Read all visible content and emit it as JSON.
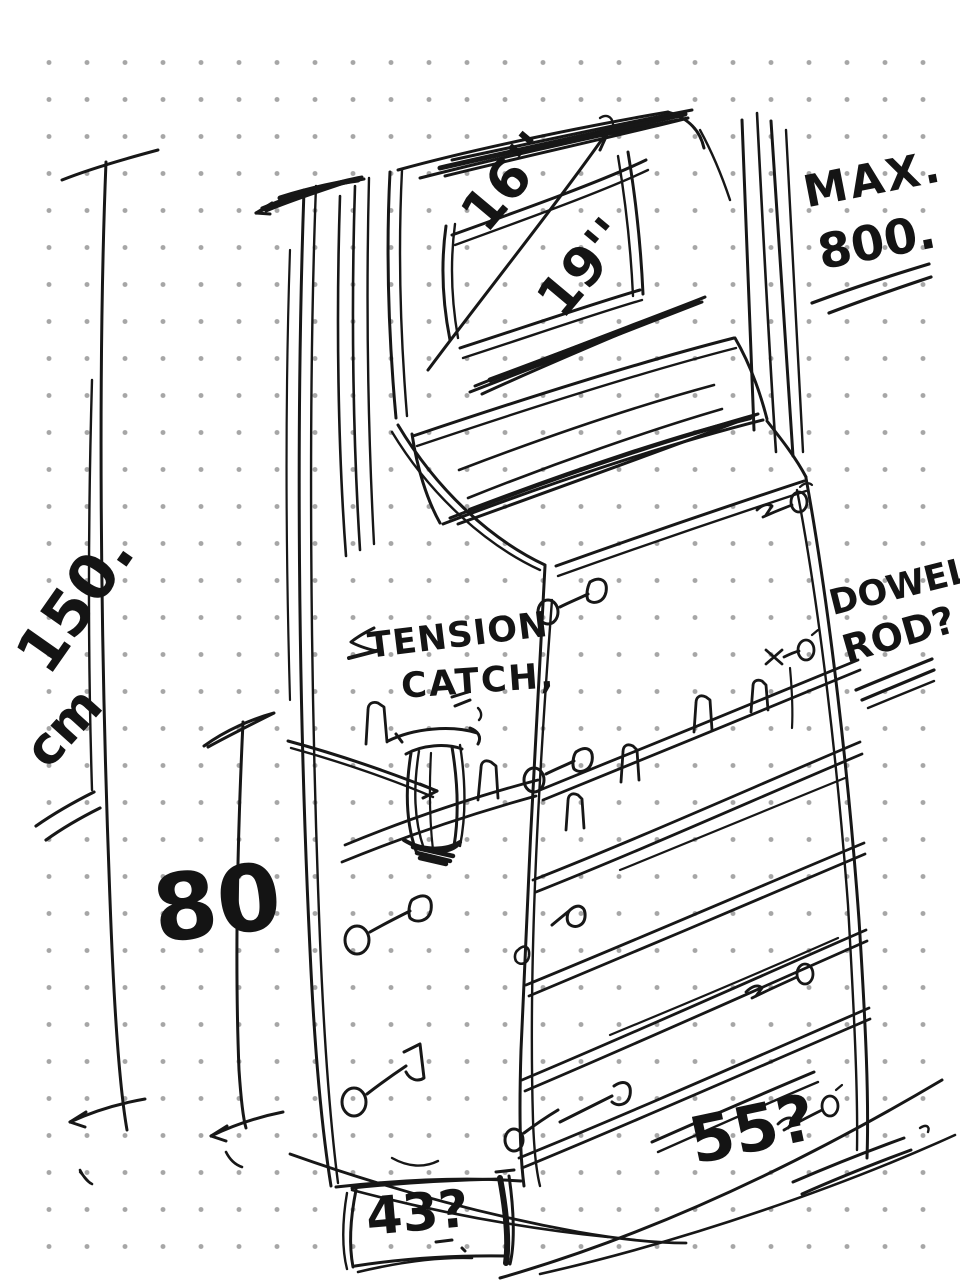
{
  "canvas": {
    "background_color": "#ffffff",
    "dot_color": "#a6a6a6",
    "ink_color": "#171717",
    "description": "Hand-drawn sketch of an arcade-style kiosk cabinet on dotted grid paper"
  },
  "labels": {
    "screen_size_primary": "16''",
    "screen_size_secondary": "19''",
    "max_title": "MAX.",
    "max_value": "800.",
    "total_height_value": "150.",
    "total_height_unit": "cm",
    "body_height_value": "80",
    "catch_note_line1": "TENSION",
    "catch_note_line2": "CATCH,",
    "dowel_note_line1": "DOWEL.",
    "dowel_note_line2": "ROD?",
    "width_query": "55?",
    "base_query": "43?"
  }
}
